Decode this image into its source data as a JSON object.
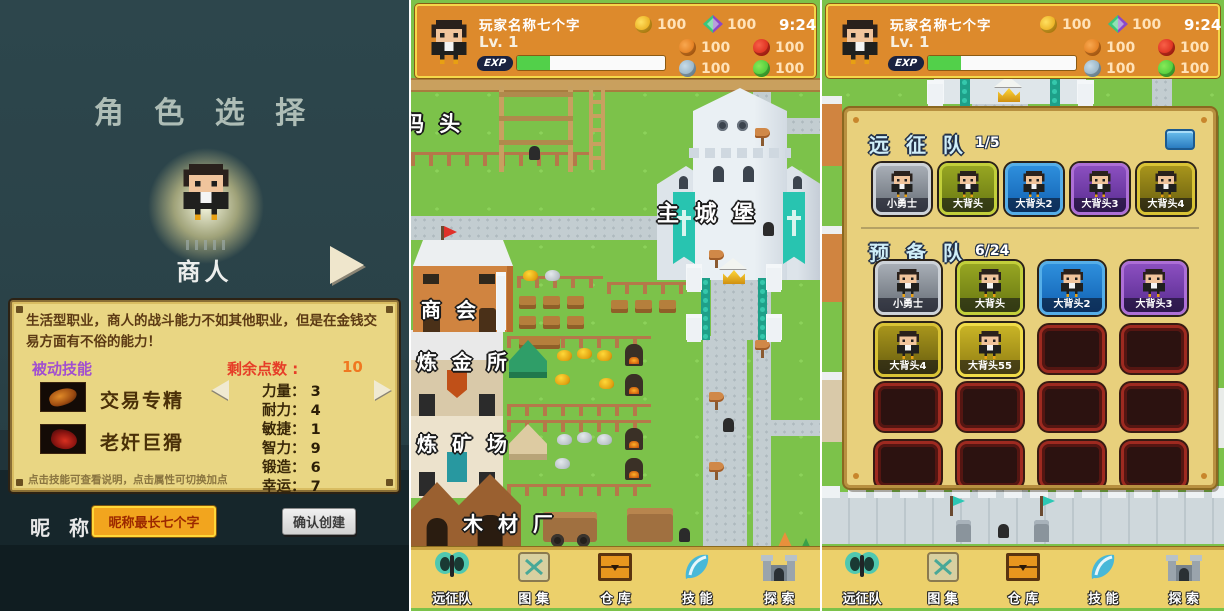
{
  "colors": {
    "hud_bg": "#dd8a2c",
    "hud_border": "#f5d84a",
    "grass": "#7cc24a",
    "card_panel": "#e9d683",
    "overlay_panel": "#e8d07c",
    "banner_teal": "#28c4b4",
    "rarity_gray": "#9aa0a8",
    "rarity_olive": "#7e8e1a",
    "rarity_blue": "#1e80cc",
    "rarity_purple": "#7640a6",
    "rarity_gold": "#8e7e14",
    "rarity_bright_gold": "#b4a01e",
    "exp_fill": "#52d04a",
    "points_red": "#e63e28",
    "passive_purple": "#a14fd0"
  },
  "char_select": {
    "title": "角 色 选 择",
    "char_name": "商人",
    "description": "生活型职业，商人的战斗能力不如其他职业，但是在金钱交易方面有不俗的能力！",
    "passive_label": "被动技能",
    "points_label": "剩余点数 :",
    "points_value": "10",
    "skills": [
      {
        "name": "交易专精"
      },
      {
        "name": "老奸巨猾"
      }
    ],
    "stats": [
      {
        "label": "力量：",
        "value": "3"
      },
      {
        "label": "耐力：",
        "value": "4"
      },
      {
        "label": "敏捷：",
        "value": "1"
      },
      {
        "label": "智力：",
        "value": "9"
      },
      {
        "label": "锻造：",
        "value": "6"
      },
      {
        "label": "幸运：",
        "value": "7"
      }
    ],
    "hint": "点击技能可查看说明，点击属性可切换加点",
    "nickname_label": "昵 称",
    "nickname_placeholder": "昵称最长七个字",
    "confirm_label": "确认创建"
  },
  "hud": {
    "player_name": "玩家名称七个字",
    "level": "Lv. 1",
    "exp_label": "EXP",
    "exp_percent": 22,
    "time": "9:24",
    "gold": "100",
    "gem": "100",
    "res_food": "100",
    "res_meat": "100",
    "res_stone": "100",
    "res_wood": "100"
  },
  "map": {
    "labels": {
      "dock": "码 头",
      "castle": "主 城 堡",
      "guild": "商 会",
      "alchemy": "炼 金 所",
      "mine": "炼 矿 场",
      "lumber": "木 材 厂"
    }
  },
  "nav": {
    "items": [
      {
        "label": "远征队"
      },
      {
        "label": "图 集"
      },
      {
        "label": "仓 库"
      },
      {
        "label": "技 能"
      },
      {
        "label": "探 索"
      }
    ]
  },
  "expedition": {
    "title": "远 征 队",
    "count": "1/5",
    "team": [
      {
        "name": "小勇士"
      },
      {
        "name": "大背头"
      },
      {
        "name": "大背头2"
      },
      {
        "name": "大背头3"
      },
      {
        "name": "大背头4"
      }
    ],
    "reserve_title": "预 备 队",
    "reserve_count": "6/24",
    "reserve": [
      {
        "name": "小勇士"
      },
      {
        "name": "大背头"
      },
      {
        "name": "大背头2"
      },
      {
        "name": "大背头3"
      },
      {
        "name": "大背头4"
      },
      {
        "name": "大背头55"
      }
    ]
  }
}
